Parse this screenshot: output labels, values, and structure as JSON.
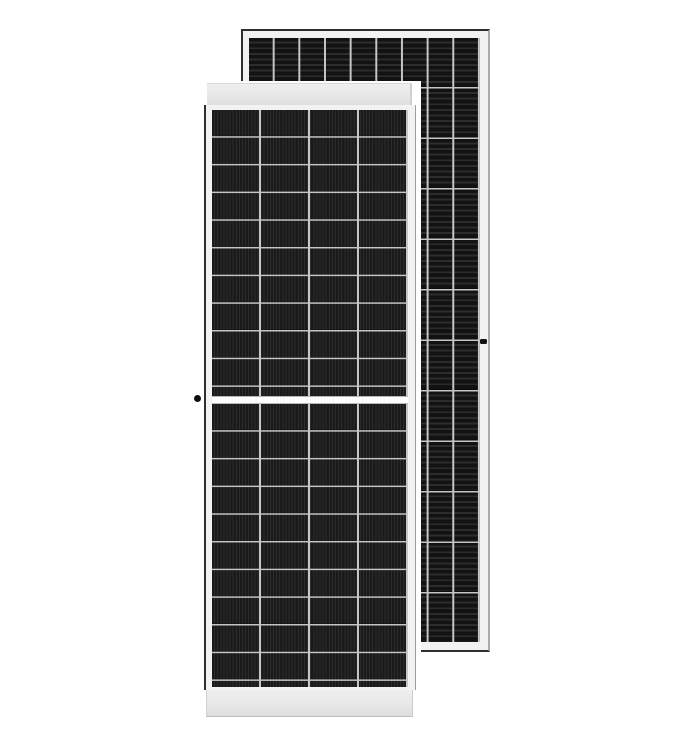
{
  "scene": {
    "description": "Product render of two black monocrystalline half-cut solar panels on a white background; a portrait front-view panel overlaps a second panel behind it to the upper right",
    "background_color": "#ffffff",
    "text_content": "none"
  },
  "front_panel": {
    "view": "front",
    "orientation": "portrait",
    "cell_columns": 4,
    "cell_rows_per_half": 10,
    "halves": 2,
    "center_gap": true,
    "ribbon_direction": "vertical",
    "frame_color": "#f2f2f2",
    "rail_color": "#e8e8e8",
    "cell_color": "#1c1c1c",
    "divider_color": "#c6c6c6",
    "grounding_dot_on_left_frame": true
  },
  "rear_panel": {
    "view": "front-offset-behind",
    "orientation": "portrait",
    "cell_columns": 9,
    "cell_rows": 12,
    "ribbon_direction": "horizontal",
    "frame_color": "#f0f0f0",
    "outline_color": "#2e2e2e",
    "cell_color": "#161616",
    "divider_color": "#c6c6c6",
    "grounding_mark_on_right_frame": true
  },
  "css_vars": {
    "front-cols": "4",
    "front-row-h": "27.7px",
    "back-cols": "9",
    "back-row-h": "50.5px",
    "divider": "#c6c6c6",
    "front-cell": "#1c1c1c",
    "back-cell": "#161616",
    "stripe-light": "#2c2c2c",
    "frame-white": "#f2f2f2",
    "outline-dark": "#2e2e2e"
  }
}
